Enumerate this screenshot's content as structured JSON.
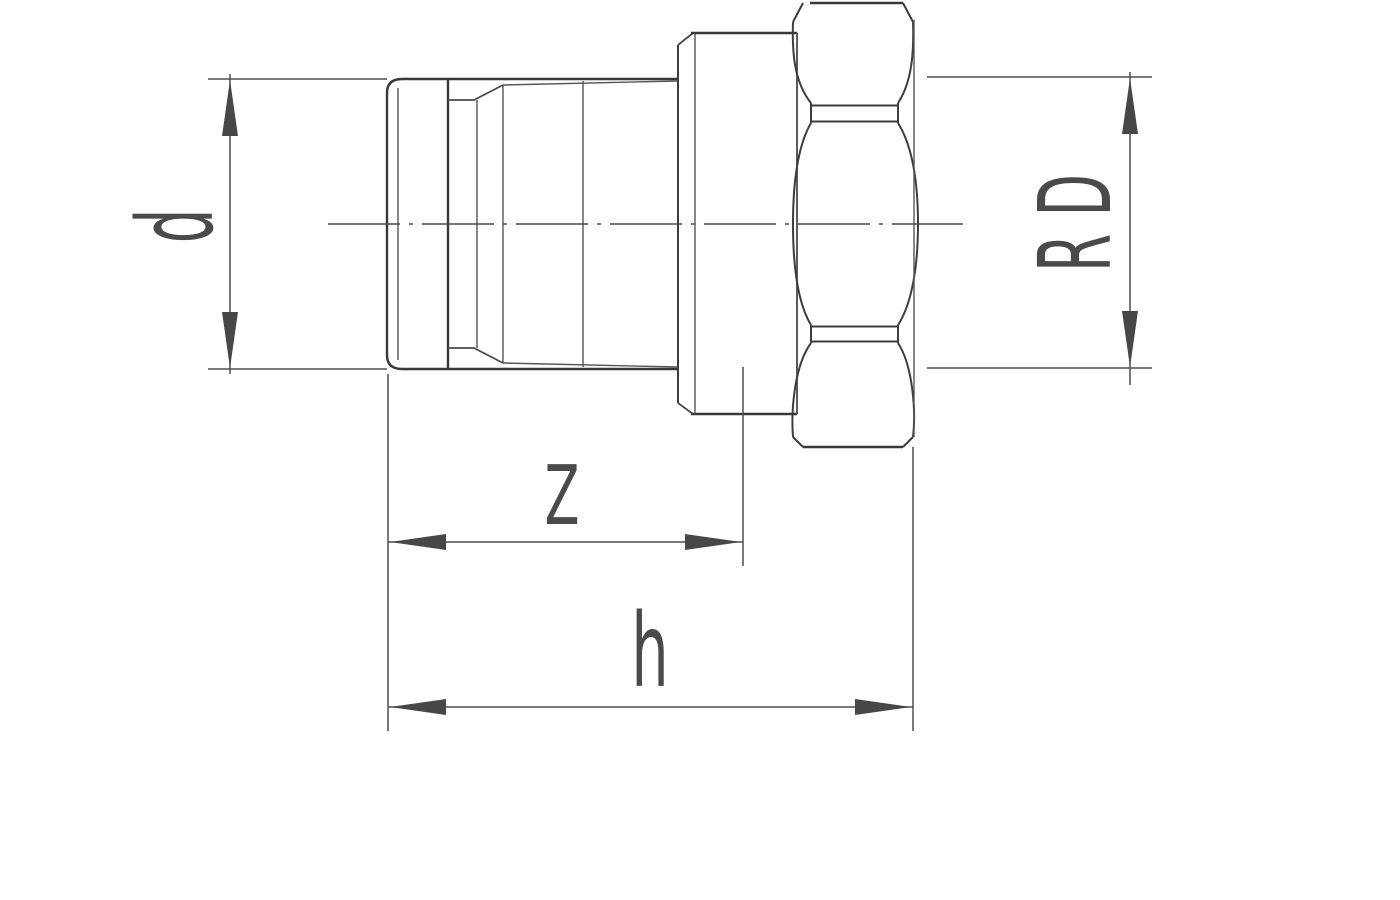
{
  "drawing": {
    "kind": "technical line drawing, side view of a threaded tailpiece union fitting with hex union nut",
    "labels": {
      "diameter": "d",
      "thread": "R D",
      "engagement_length": "Z",
      "overall_length": "h"
    },
    "colors": {
      "background": "#ffffff",
      "outline": "#383838",
      "thin_line": "#555555",
      "dimension_line": "#4f4f4f",
      "arrow_fill": "#474747",
      "label_text": "#4a4a4a"
    }
  }
}
